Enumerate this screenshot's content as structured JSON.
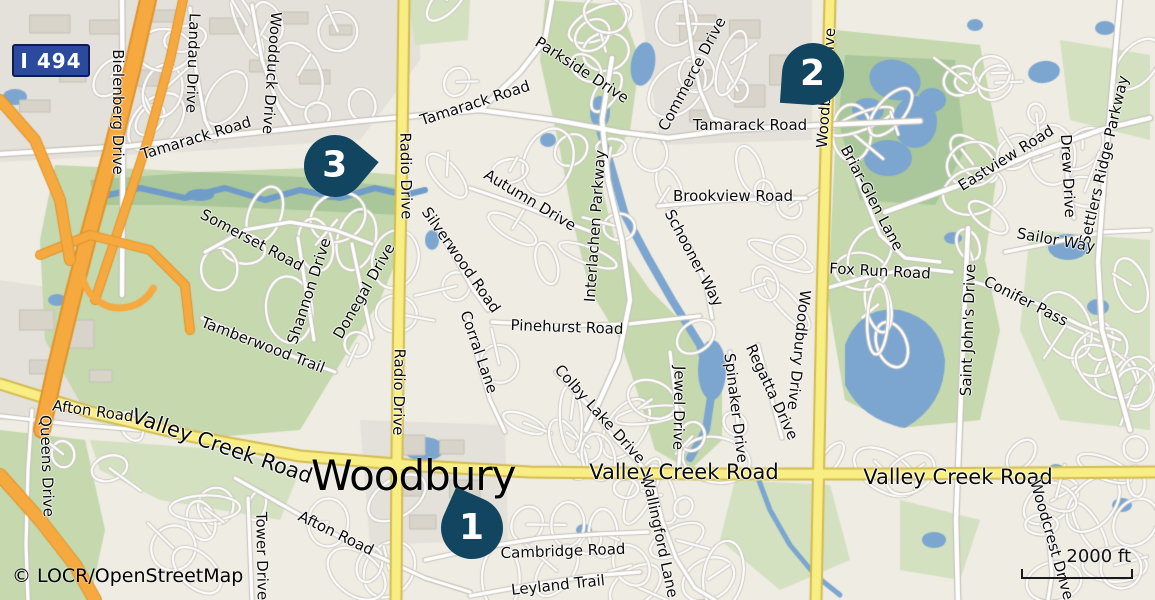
{
  "map": {
    "attribution": "© LOCR/OpenStreetMap",
    "scale": {
      "label": "2000 ft"
    },
    "city": {
      "label": "Woodbury"
    },
    "shield": {
      "label": "I 494"
    },
    "markers": [
      {
        "number": "1"
      },
      {
        "number": "2"
      },
      {
        "number": "3"
      }
    ],
    "street_labels": [
      {
        "text": "Bielenberg Drive"
      },
      {
        "text": "Landau Drive"
      },
      {
        "text": "Woodduck Drive"
      },
      {
        "text": "Tamarack Road"
      },
      {
        "text": "Tamarack Road"
      },
      {
        "text": "Parkside Drive"
      },
      {
        "text": "Commerce Drive"
      },
      {
        "text": "Tamarack Road"
      },
      {
        "text": "Woodbury Drive"
      },
      {
        "text": "Brookview Road"
      },
      {
        "text": "Briar-Glen Lane"
      },
      {
        "text": "Eastview Road"
      },
      {
        "text": "Drew Drive"
      },
      {
        "text": "Settlers Ridge Parkway"
      },
      {
        "text": "Sailor Way"
      },
      {
        "text": "Fox Run Road"
      },
      {
        "text": "Conifer Pass"
      },
      {
        "text": "Saint John's Drive"
      },
      {
        "text": "Woodbury Drive"
      },
      {
        "text": "Radio Drive"
      },
      {
        "text": "Radio Drive"
      },
      {
        "text": "Autumn Drive"
      },
      {
        "text": "Silverwood Road"
      },
      {
        "text": "Interlachen Parkway"
      },
      {
        "text": "Schooner Way"
      },
      {
        "text": "Somerset Road"
      },
      {
        "text": "Shannon Drive"
      },
      {
        "text": "Donegal Drive"
      },
      {
        "text": "Tamberwood Trail"
      },
      {
        "text": "Pinehurst Road"
      },
      {
        "text": "Corral Lane"
      },
      {
        "text": "Colby Lake Drive"
      },
      {
        "text": "Jewel Drive"
      },
      {
        "text": "Spinaker Drive"
      },
      {
        "text": "Regatta Drive"
      },
      {
        "text": "Valley Creek Road"
      },
      {
        "text": "Afton Road"
      },
      {
        "text": "Queens Drive"
      },
      {
        "text": "Valley Creek Road"
      },
      {
        "text": "Valley Creek Road"
      },
      {
        "text": "Afton Road"
      },
      {
        "text": "Tower Drive"
      },
      {
        "text": "Wallingford Lane"
      },
      {
        "text": "Cambridge Road"
      },
      {
        "text": "Leyland Trail"
      },
      {
        "text": "Woodcrest Drive"
      }
    ],
    "colors": {
      "base": "#efece3",
      "urban": "#e4e1da",
      "building": "#d8d4ca",
      "park": "#c5d8ae",
      "park_light": "#d3e1c1",
      "park_dark": "#a9c79a",
      "water": "#7ca6d0",
      "water_dark": "#6f9cc9",
      "road_fill": "#ffffff",
      "road_casing": "#c6c2b9",
      "primary": "#f8ee84",
      "primary_casing": "#d3bc50",
      "motorway": "#f5a93f",
      "motorway_casing": "#e0942b",
      "marker": "#114560",
      "shield_bg": "#2b4a9d"
    }
  }
}
